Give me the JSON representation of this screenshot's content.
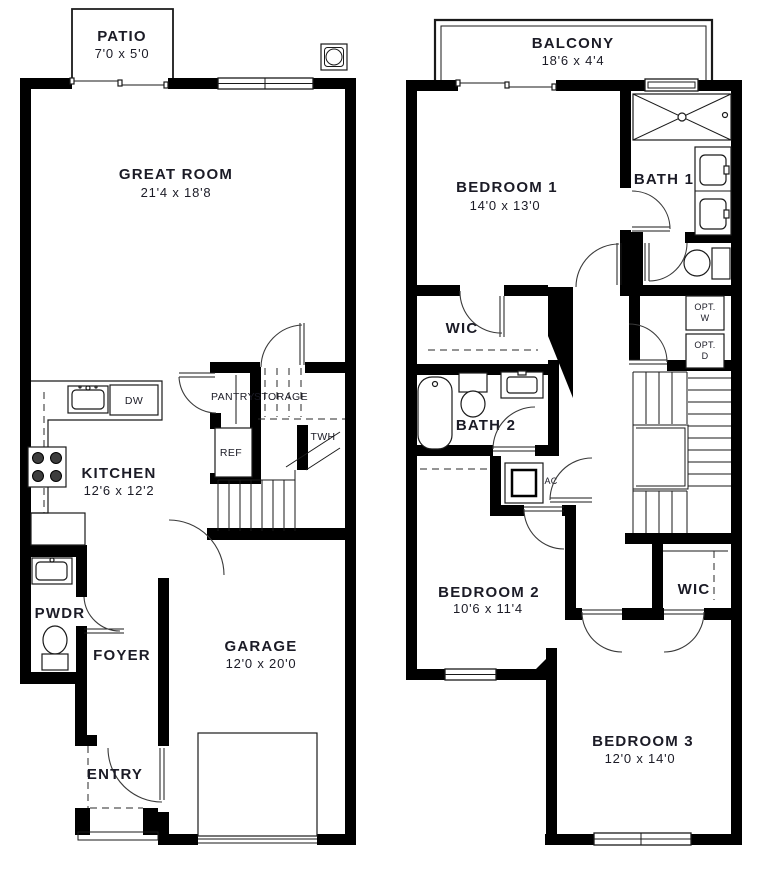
{
  "palette": {
    "wall": "#000000",
    "line": "#1a1a1a",
    "text": "#1b1b26",
    "background": "#ffffff"
  },
  "floor1": {
    "patio": {
      "name": "PATIO",
      "dims": "7'0 x 5'0"
    },
    "great_room": {
      "name": "GREAT ROOM",
      "dims": "21'4 x 18'8"
    },
    "kitchen": {
      "name": "KITCHEN",
      "dims": "12'6 x 12'2"
    },
    "dw": {
      "name": "DW"
    },
    "pantry": {
      "name": "PANTRY"
    },
    "storage": {
      "name": "STORAGE"
    },
    "ref": {
      "name": "REF"
    },
    "twh": {
      "name": "TWH"
    },
    "pwdr": {
      "name": "PWDR"
    },
    "foyer": {
      "name": "FOYER"
    },
    "garage": {
      "name": "GARAGE",
      "dims": "12'0 x 20'0"
    },
    "entry": {
      "name": "ENTRY"
    }
  },
  "floor2": {
    "balcony": {
      "name": "BALCONY",
      "dims": "18'6 x 4'4"
    },
    "bedroom1": {
      "name": "BEDROOM 1",
      "dims": "14'0 x 13'0"
    },
    "bath1": {
      "name": "BATH 1"
    },
    "wic_upper": {
      "name": "WIC"
    },
    "opt_washer": {
      "line1": "OPT.",
      "line2": "W"
    },
    "opt_dryer": {
      "line1": "OPT.",
      "line2": "D"
    },
    "bath2": {
      "name": "BATH 2"
    },
    "ac": {
      "name": "AC"
    },
    "bedroom2": {
      "name": "BEDROOM 2",
      "dims": "10'6 x 11'4"
    },
    "wic_lower": {
      "name": "WIC"
    },
    "bedroom3": {
      "name": "BEDROOM 3",
      "dims": "12'0 x 14'0"
    }
  }
}
